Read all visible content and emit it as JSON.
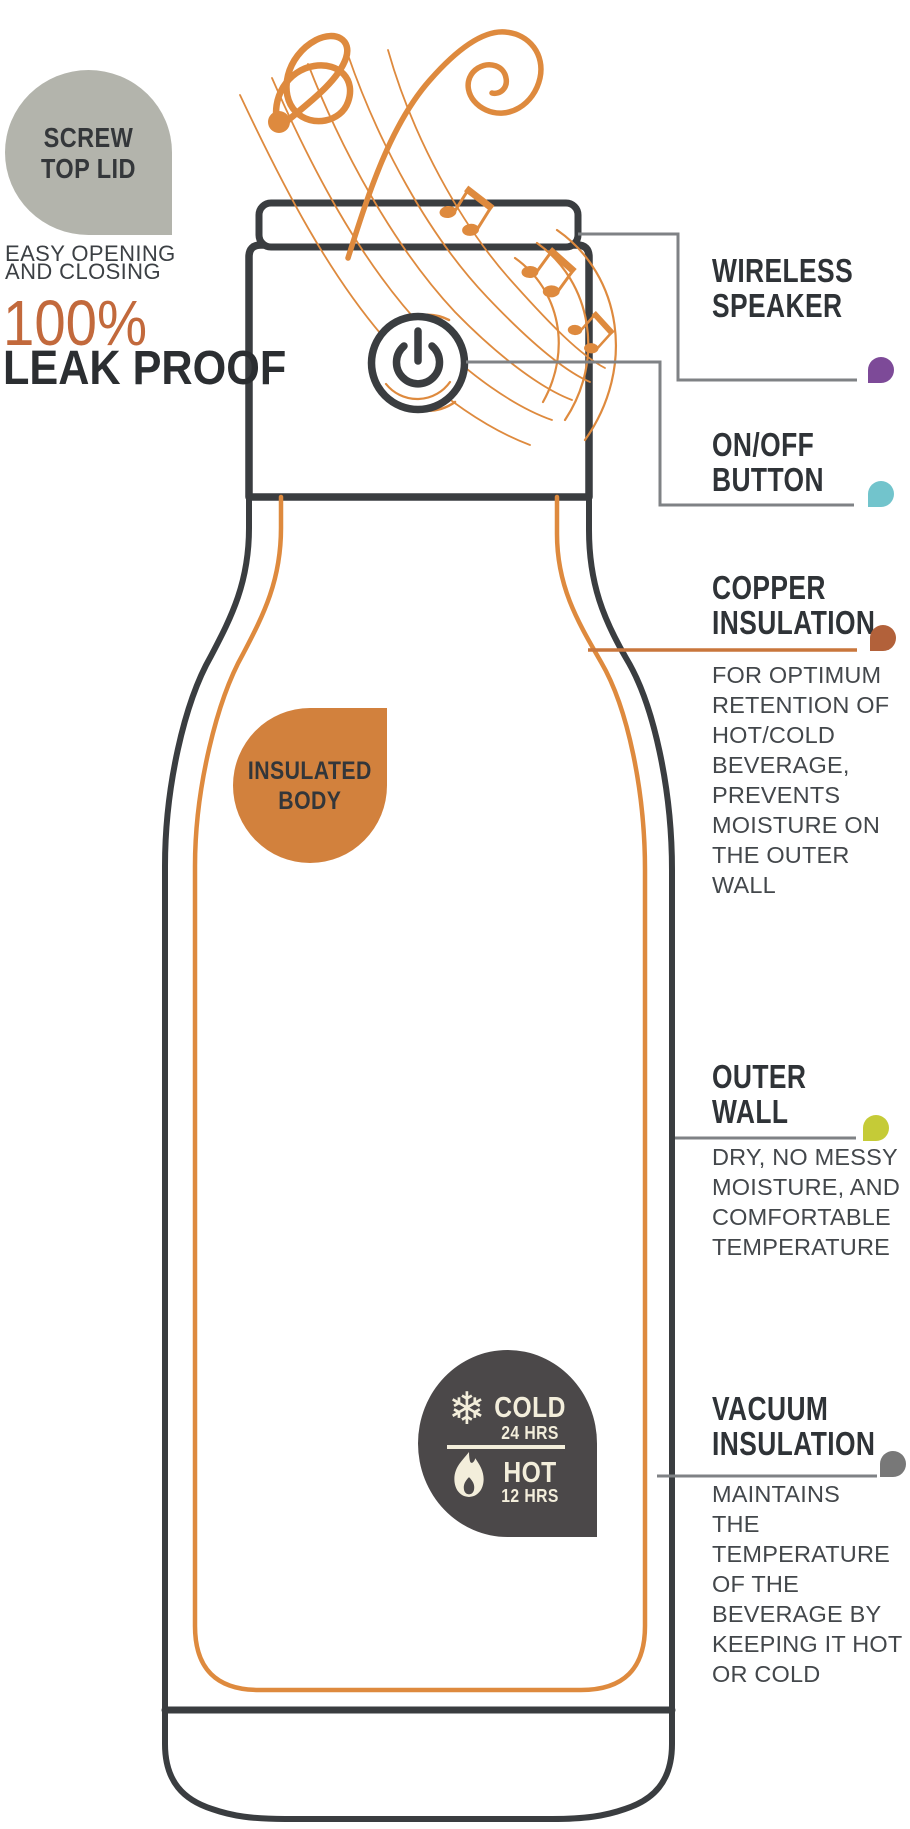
{
  "colors": {
    "outline_dark": "#3a3d40",
    "swirl_orange": "#de8a3e",
    "copper_line": "#c9763c",
    "bubble_gray": "#b3b4ac",
    "bubble_orange": "#d2813d",
    "percent_orange": "#c2693c",
    "badge_dark": "#4b4849",
    "badge_cream": "#f3eedb",
    "connector_gray": "#7f8285"
  },
  "lid_bubble": {
    "label": "SCREW\nTOP LID"
  },
  "left_column": {
    "subtitle": "EASY OPENING\nAND CLOSING",
    "percent": "100%",
    "leak_proof": "LEAK PROOF"
  },
  "insulated_body": {
    "label": "INSULATED\nBODY"
  },
  "badge": {
    "cold_label": "COLD",
    "cold_duration": "24 HRS",
    "hot_label": "HOT",
    "hot_duration": "12 HRS"
  },
  "callouts": [
    {
      "title": "WIRELESS\nSPEAKER",
      "description": "",
      "dot_color": "#7d4a98"
    },
    {
      "title": "ON/OFF\nBUTTON",
      "description": "",
      "dot_color": "#72c4cc"
    },
    {
      "title": "COPPER\nINSULATION",
      "description": "FOR OPTIMUM\nRETENTION OF\nHOT/COLD\nBEVERAGE,\nPREVENTS\nMOISTURE ON\nTHE OUTER\nWALL",
      "dot_color": "#b2613a"
    },
    {
      "title": "OUTER\nWALL",
      "description": "DRY, NO MESSY\nMOISTURE, AND\nCOMFORTABLE\nTEMPERATURE",
      "dot_color": "#c5cb37"
    },
    {
      "title": "VACUUM\nINSULATION",
      "description": "MAINTAINS\nTHE\nTEMPERATURE\nOF THE\nBEVERAGE BY\nKEEPING IT HOT\nOR COLD",
      "dot_color": "#787878"
    }
  ]
}
